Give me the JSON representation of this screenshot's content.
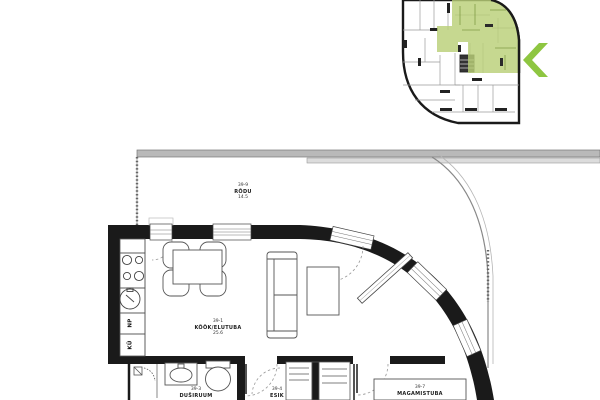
{
  "colors": {
    "wall": "#1a1a1a",
    "thin_line": "#555555",
    "railing_fill": "#b9b9b9",
    "highlight_green": "#b9cf78",
    "chevron_green": "#8ec641"
  },
  "icons": {
    "carousel_prev": "chevron-left"
  },
  "overview": {
    "description": "building floor overview with highlighted apartment"
  },
  "rooms": {
    "balcony": {
      "number": "39-9",
      "name": "RÕDU",
      "area": "14.5"
    },
    "kitchen_living": {
      "number": "39-1",
      "name": "KÖÖK/ELUTUBA",
      "area": "25.6"
    },
    "shower_room": {
      "number": "39-3",
      "name": "DUŠIRUUM"
    },
    "hallway": {
      "number": "39-4",
      "name": "ESIK"
    },
    "bedroom": {
      "number": "39-7",
      "name": "MAGAMISTUBA"
    }
  },
  "kitchen_labels": {
    "dishwasher": "NP",
    "fridge": "KÜ"
  }
}
